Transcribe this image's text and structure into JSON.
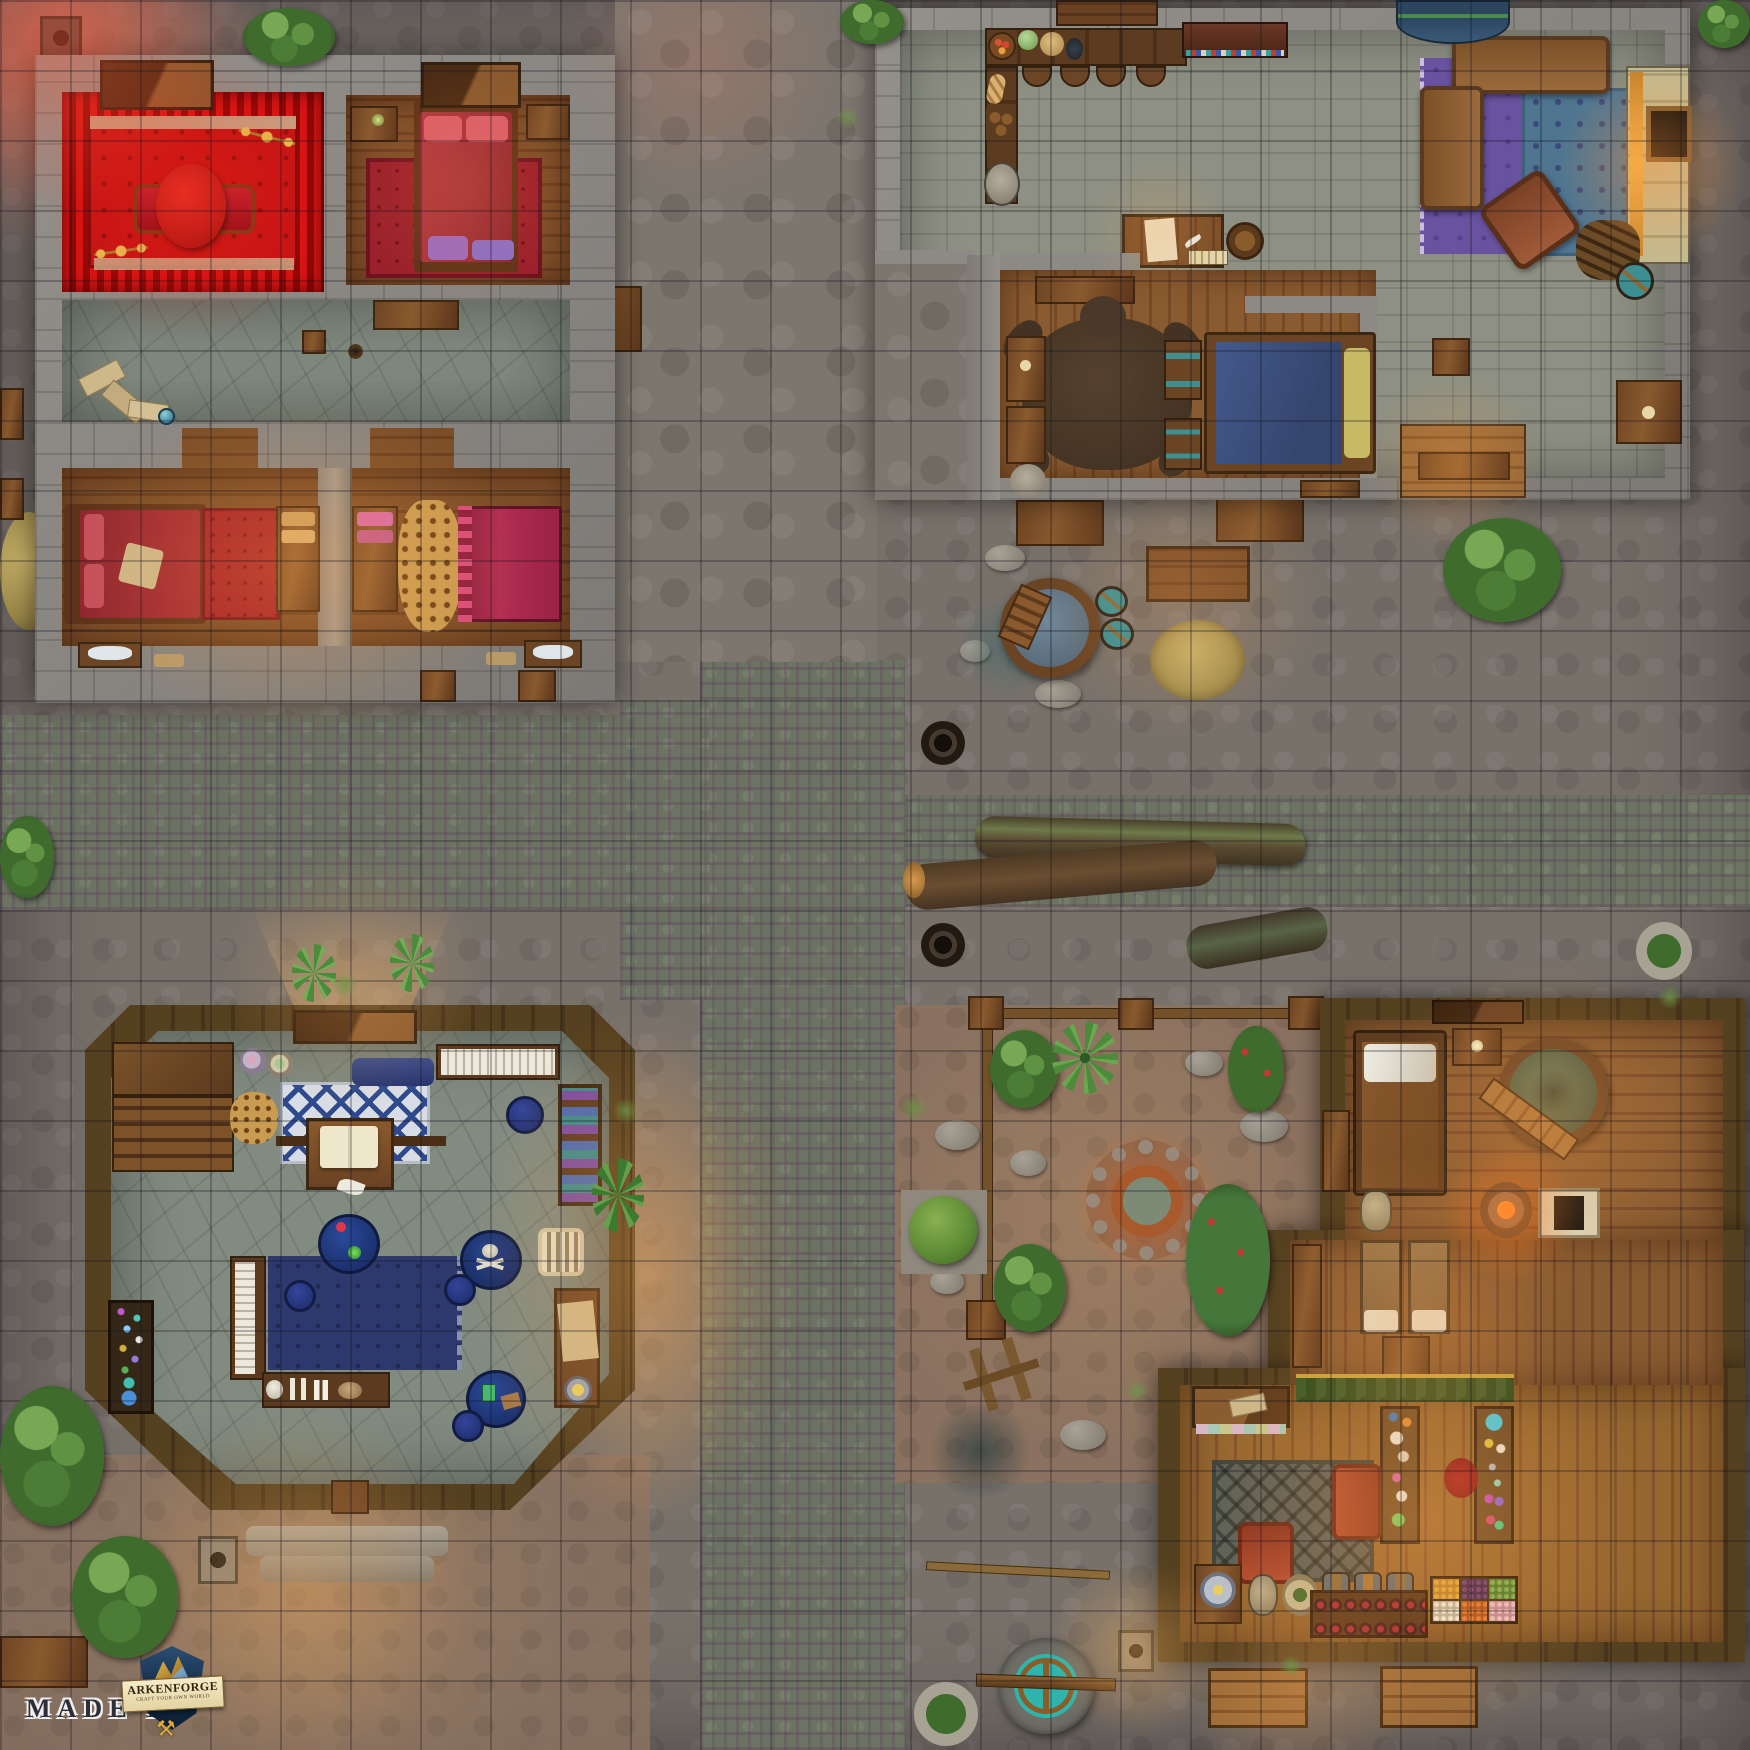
{
  "watermark": {
    "made_by": "MADE BY",
    "logo_title": "ARKENFORGE",
    "logo_subtitle": "CRAFT YOUR OWN WORLD",
    "hammer_icon": "⚒"
  },
  "map": {
    "type": "top-down fantasy village battle map, night scene with lamp light",
    "grid": {
      "columns": 25,
      "rows": 25,
      "cell_px": 70,
      "line_color": "#12121e"
    },
    "palette": {
      "street_stone": "#78716a",
      "street_moss_cobble": "#6d7363",
      "courtyard_dirt": "#8b7260",
      "stone_wall": "#8d8a85",
      "wood_wall": "#4e3a20",
      "wood_floor": "#7c4e28",
      "stone_floor": "#8d9083",
      "carpet_red": "#c41414",
      "rug_navy": "#2e3a6e",
      "rug_purple": "#6952a0",
      "rug_blue": "#4f7591",
      "rug_grey": "#5a5f58",
      "water_teal": "#3fb8b2",
      "bath_water": "#5d6e52",
      "glow_warm": "#ffb45e",
      "glow_red": "#ff5a3c"
    },
    "buildings": [
      {
        "id": "inn",
        "label": "stone inn with red rooms",
        "rooms": [
          "red-curtained-parlor",
          "red-double-bedroom",
          "stone-hallway",
          "long-twin-bedroom"
        ],
        "furniture": [
          "round-red-table",
          "red-chaise",
          "gold-candelabras",
          "red-double-bed",
          "purple-foot-cushions",
          "nightstands",
          "red-single-bed",
          "magenta-single-bed",
          "dressers-with-towels",
          "leopard-pelt-rug",
          "washstands",
          "scattered-scrolls",
          "hall-bench",
          "cellar-doors"
        ]
      },
      {
        "id": "lodge",
        "label": "stone lodge with kitchen and lounge",
        "rooms": [
          "kitchen-bar",
          "great-hall",
          "blue-bedroom",
          "rug-lounge"
        ],
        "furniture": [
          "l-shaped-counter-with-food",
          "bar-stools",
          "spice-shelf",
          "writing-desk",
          "barrel",
          "grinding-stone",
          "bear-skin-rug",
          "blue-bed-with-yellow-pillow",
          "barrel-chests",
          "cabinets",
          "purple-rug",
          "blue-rug",
          "brown-sofas",
          "angled-armchair",
          "fireplace",
          "firewood-pile",
          "teal-barrel",
          "crate",
          "leaning-canoe",
          "wooden-deck-bench"
        ]
      },
      {
        "id": "curiosity-shop",
        "label": "octagonal wooden curiosity shop",
        "rooms": [
          "shop-floor"
        ],
        "furniture": [
          "staircase",
          "food-plates",
          "leopard-pelt",
          "diamond-rug",
          "blue-bedroll",
          "lectern-with-open-book",
          "scroll-rack",
          "bookshelf",
          "blue-round-tables",
          "skull-painted-table",
          "blue-stools",
          "navy-rug",
          "display-counter-with-skulls",
          "gem-table",
          "bone-birdcage",
          "writing-desk-with-bowl",
          "entrance-steps"
        ]
      },
      {
        "id": "bathhouse",
        "label": "wooden bathhouse and apothecary shop",
        "rooms": [
          "bedroom",
          "bath-corner",
          "massage-room",
          "potion-shop"
        ],
        "furniture": [
          "single-bed",
          "nightstand-with-candle",
          "round-hot-tub",
          "angled-bench",
          "stone-head-statue",
          "brazier-with-panel",
          "wardrobe",
          "massage-tables-with-towels",
          "pedestal",
          "green-scalloped-awning",
          "potion-display-tables",
          "red-armchairs",
          "grey-rug",
          "cushion-bench",
          "crate-with-frying-pan",
          "stone-face-plaque",
          "herb-plate",
          "wine-bottle-rack",
          "small-barrels",
          "produce-crates",
          "porch-tables"
        ]
      }
    ],
    "street_features": [
      "mossy-cobble-cross-streets",
      "flagstone-paths",
      "red-lamplit-corner",
      "street-lamps",
      "manhole-covers",
      "large-water-tub-with-ladder",
      "teal-water-barrels",
      "hay-piles",
      "fallen-mossy-logs",
      "fenced-dirt-courtyard",
      "stone-fire-fountain",
      "garden-plants",
      "berry-bushes",
      "agave-plants",
      "round-shrub-on-slab",
      "broken-chair",
      "dark-puddles",
      "stone-well-with-beam",
      "potted-plants",
      "wooden-benches-and-tables",
      "entrance-light-cones"
    ]
  }
}
